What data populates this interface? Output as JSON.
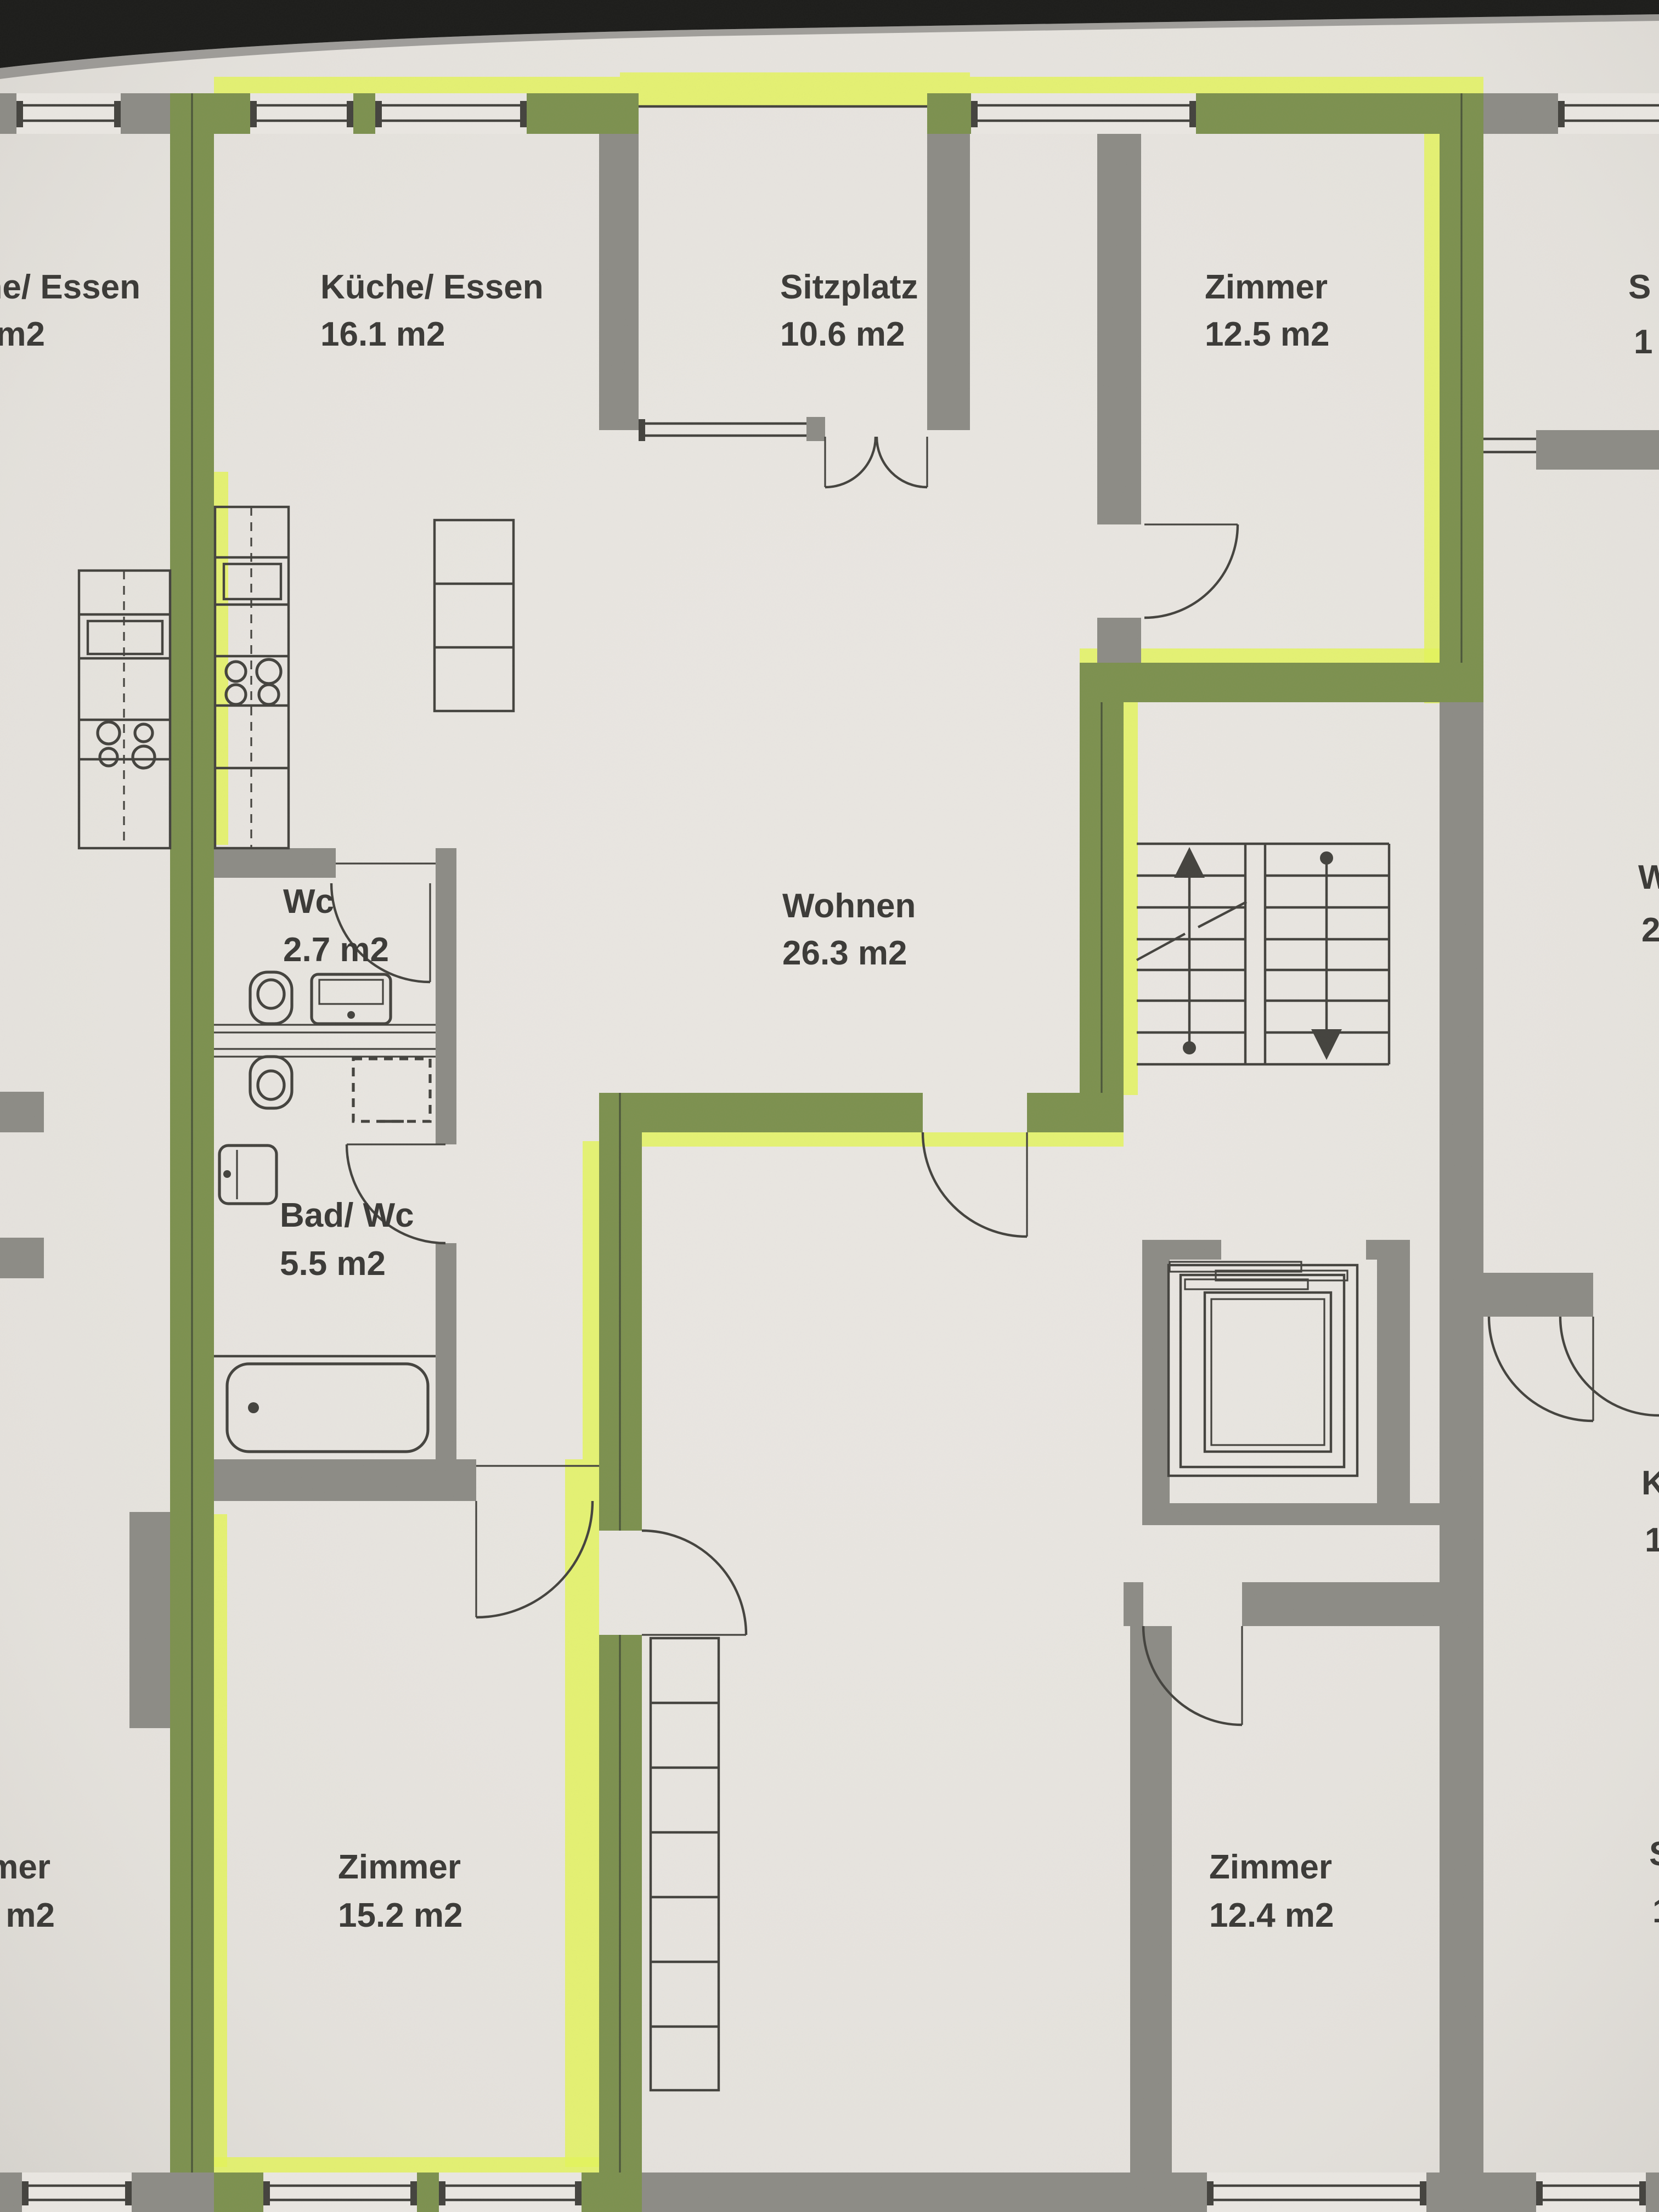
{
  "photo": {
    "kind": "architectural floor plan, photographed printout",
    "highlighted_unit_note": "one apartment outlined with yellow-green highlighter"
  },
  "colors": {
    "paper": "#e9e6e1",
    "paper-dark": "#d6d3cc",
    "wall": "#8d8c86",
    "wall-green": "#7d9150",
    "highlight": "#e3f35c",
    "ink": "#3c3b38",
    "line": "#45443f",
    "shadow": "#1e1e1c"
  },
  "rooms": [
    {
      "id": "kueche",
      "name": "Küche/ Essen",
      "area": "16.1 m2"
    },
    {
      "id": "sitzplatz",
      "name": "Sitzplatz",
      "area": "10.6 m2"
    },
    {
      "id": "zimmer-ne",
      "name": "Zimmer",
      "area": "12.5 m2"
    },
    {
      "id": "wc",
      "name": "Wc",
      "area": "2.7 m2"
    },
    {
      "id": "wohnen",
      "name": "Wohnen",
      "area": "26.3 m2"
    },
    {
      "id": "bad-wc",
      "name": "Bad/ Wc",
      "area": "5.5 m2"
    },
    {
      "id": "zimmer-sw",
      "name": "Zimmer",
      "area": "15.2 m2"
    },
    {
      "id": "zimmer-se",
      "name": "Zimmer",
      "area": "12.4 m2"
    }
  ],
  "edge_fragments": [
    {
      "side": "left-top",
      "line1": "he/ Essen",
      "line2": "m2"
    },
    {
      "side": "left-bottom",
      "line1": "mer",
      "line2": "m2"
    },
    {
      "side": "right-top",
      "line1": "S",
      "line2": "1"
    },
    {
      "side": "right-middle",
      "line1": "W",
      "line2": "2"
    },
    {
      "side": "right-lower",
      "line1": "K",
      "line2": "1"
    },
    {
      "side": "right-bottom",
      "line1": "S",
      "line2": "1"
    }
  ]
}
